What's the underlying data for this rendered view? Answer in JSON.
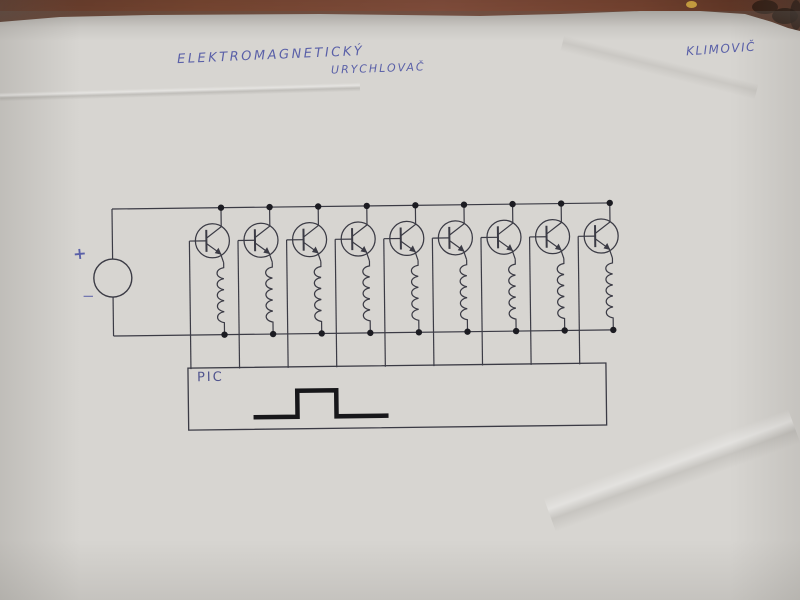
{
  "photo": {
    "handwriting": {
      "title_line1": "ELEKTROMAGNETICKÝ",
      "title_line2": "URYCHLOVAČ",
      "author": "KLIMOVIČ"
    },
    "colors": {
      "table": "#7d4a34",
      "paper": "#d7d5d1",
      "ink": "#3b3b45",
      "blue_ink": "#5a60a8",
      "pulse": "#17171a"
    }
  },
  "circuit": {
    "source": {
      "plus_label": "+",
      "minus_label": "−"
    },
    "stage_count": 9,
    "controller_label": "PIC"
  }
}
